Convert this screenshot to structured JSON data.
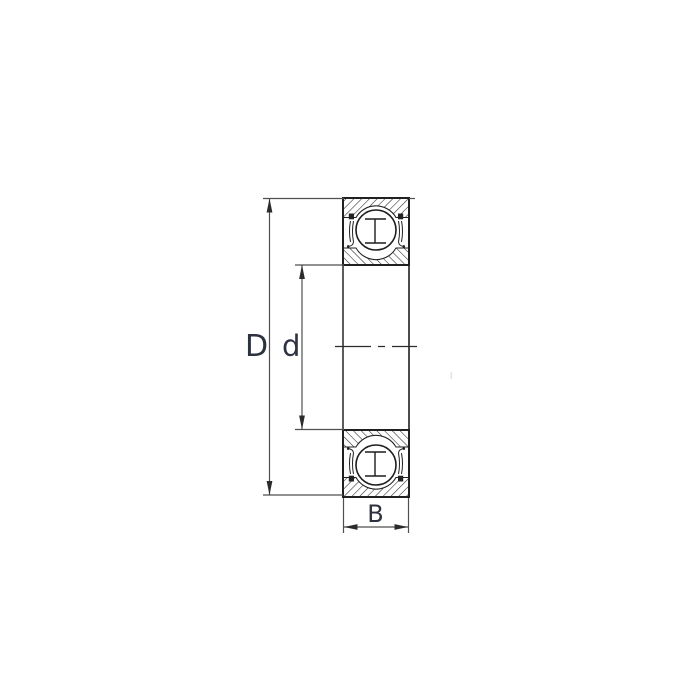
{
  "labels": {
    "outer_diameter": "D",
    "bore_diameter": "d",
    "width": "B"
  },
  "colors": {
    "background": "#ffffff",
    "outline": "#1f1f1f",
    "hatch": "#262626",
    "dimension_line": "#4f4f4f",
    "arrow": "#2b2b2b",
    "label_text": "#2e3140"
  }
}
